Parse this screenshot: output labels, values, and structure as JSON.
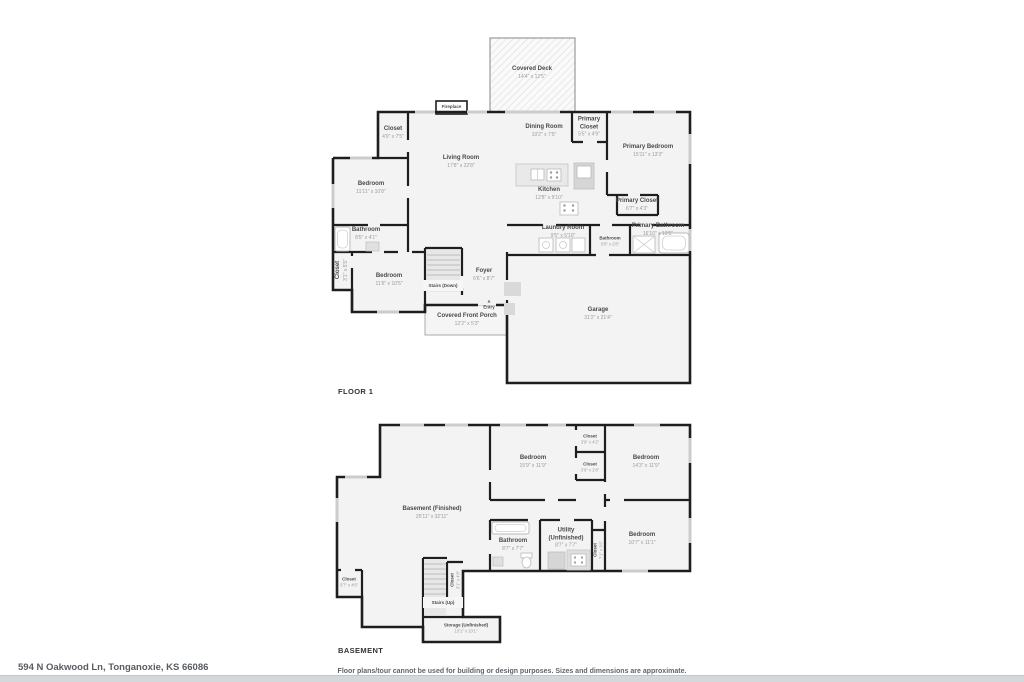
{
  "floor1": {
    "label": "FLOOR 1",
    "entry_icon": "▲",
    "rooms": {
      "covered_deck": {
        "name": "Covered Deck",
        "dims": "14'4\" x 12'5\""
      },
      "fireplace": {
        "name": "Fireplace"
      },
      "closet_top": {
        "name": "Closet",
        "dims": "4'0\" x 7'5\""
      },
      "living_room": {
        "name": "Living Room",
        "dims": "17'8\" x 22'8\""
      },
      "dining_room": {
        "name": "Dining Room",
        "dims": "10'2\" x 7'5\""
      },
      "primary_closet_a": {
        "name": "Primary Closet",
        "dims": "5'5\" x 4'9\""
      },
      "primary_bedroom": {
        "name": "Primary Bedroom",
        "dims": "15'11\" x 13'3\""
      },
      "bedroom_left": {
        "name": "Bedroom",
        "dims": "11'11\" x 10'8\""
      },
      "kitchen": {
        "name": "Kitchen",
        "dims": "12'8\" x 9'10\""
      },
      "primary_closet_b": {
        "name": "Primary Closet",
        "dims": "6'7\" x 4'3\""
      },
      "bathroom_left": {
        "name": "Bathroom",
        "dims": "8'5\" x 4'1\""
      },
      "closet_left": {
        "name": "Closet",
        "dims": "3'1\" x 5'5\""
      },
      "bedroom_lower": {
        "name": "Bedroom",
        "dims": "11'6\" x 10'5\""
      },
      "stairs_down": {
        "name": "Stairs (Down)"
      },
      "foyer": {
        "name": "Foyer",
        "dims": "6'6\" x 8'7\""
      },
      "laundry_room": {
        "name": "Laundry Room",
        "dims": "9'5\" x 5'10\""
      },
      "bathroom_small": {
        "name": "Bathroom",
        "dims": "5'9\" x 2'8\""
      },
      "primary_bathroom": {
        "name": "Primary Bathroom",
        "dims": "16'10\" x 10'5\""
      },
      "entry": {
        "name": "Entry"
      },
      "covered_front_porch": {
        "name": "Covered Front Porch",
        "dims": "12'2\" x 5'3\""
      },
      "garage": {
        "name": "Garage",
        "dims": "31'2\" x 21'4\""
      }
    }
  },
  "basement": {
    "label": "BASEMENT",
    "rooms": {
      "basement_finished": {
        "name": "Basement (Finished)",
        "dims": "25'11\" x 32'11\""
      },
      "bedroom_mid": {
        "name": "Bedroom",
        "dims": "15'9\" x 11'9\""
      },
      "closet_a": {
        "name": "Closet",
        "dims": "3'9\" x 4'2\""
      },
      "closet_b": {
        "name": "Closet",
        "dims": "3'9\" x 2'8\""
      },
      "bedroom_right_top": {
        "name": "Bedroom",
        "dims": "14'3\" x 11'9\""
      },
      "bathroom": {
        "name": "Bathroom",
        "dims": "8'7\" x 7'7\""
      },
      "utility": {
        "name": "Utility (Unfinished)",
        "dims": "8'7\" x 7'7\""
      },
      "closet_vertical": {
        "name": "Closet",
        "dims": "7'1\" x 3'5\""
      },
      "bedroom_right_bottom": {
        "name": "Bedroom",
        "dims": "10'7\" x 11'1\""
      },
      "closet_bottom_left": {
        "name": "Closet",
        "dims": "3'7\" x 4'6\""
      },
      "closet_stairs": {
        "name": "Closet",
        "dims": "3'1\" x 4'8\""
      },
      "stairs_up": {
        "name": "Stairs (Up)"
      },
      "storage": {
        "name": "Storage (Unfinished)",
        "dims": "13'1\" x 10'1\""
      }
    }
  },
  "footer": {
    "address": "594 N Oakwood Ln, Tonganoxie, KS 66086",
    "disclaimer": "Floor plans/tour cannot be used for building or design purposes. Sizes and dimensions are approximate."
  }
}
